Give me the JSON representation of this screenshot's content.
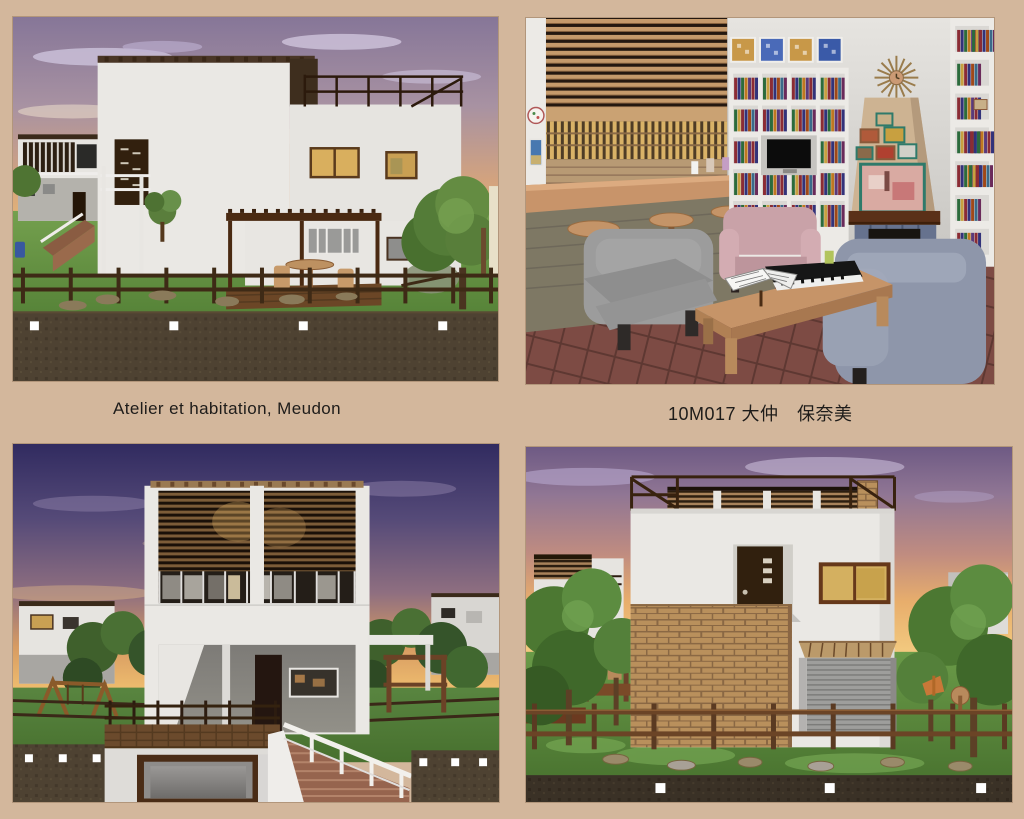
{
  "page": {
    "background_color": "#d3b79c",
    "caption_color": "#1e1c1a"
  },
  "captions": {
    "left": "Atelier et habitation, Meudon",
    "right": "10M017 大仲　保奈美"
  },
  "panels": [
    {
      "alt": "render-exterior-side-view-sunset"
    },
    {
      "alt": "render-interior-lounge-bookshelves-fireplace"
    },
    {
      "alt": "render-front-facade-dusk-stairs"
    },
    {
      "alt": "render-front-facade-brick-wall-garage"
    }
  ],
  "colors": {
    "sunset_sky_top": "#867698",
    "sunset_sky_horizon": "#f3d597",
    "dusk_sky_top": "#312b60",
    "grass": "#6a9a48",
    "wood_dark": "#4a2c14",
    "brick": "#b9905c",
    "floor_tile": "#7d4b44"
  }
}
